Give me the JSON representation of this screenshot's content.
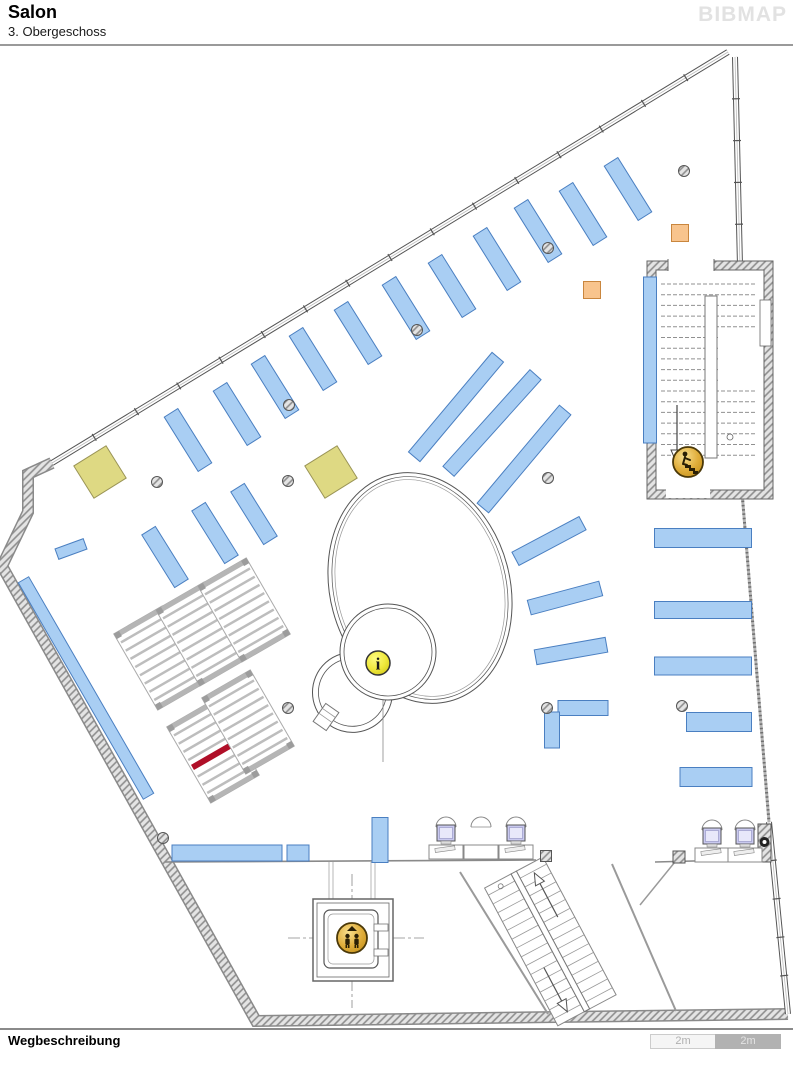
{
  "header": {
    "title": "Salon",
    "subtitle": "3. Obergeschoss",
    "logo": "BIBMAP"
  },
  "footer": {
    "directions_label": "Wegbeschreibung",
    "scale_segments": [
      {
        "label": "2m",
        "variant": "light"
      },
      {
        "label": "2m",
        "variant": "dark"
      }
    ]
  },
  "colors": {
    "shelf_fill": "#a9cef3",
    "shelf_stroke": "#4a7fc1",
    "accent_beige_fill": "#ded983",
    "accent_beige_stroke": "#9a9456",
    "accent_orange_fill": "#f8c48d",
    "accent_orange_stroke": "#c9863e",
    "highlight_red": "#b00f28",
    "icon_gold_light": "#f8df8e",
    "icon_gold_dark": "#c9951f",
    "icon_outline": "#4a3808",
    "info_yellow_light": "#fdfb80",
    "info_yellow_dark": "#d6cd1f",
    "wall_gray": "#8a8a8a",
    "line_gray": "#555555",
    "monitor_screen": "#c9c9ef"
  },
  "map": {
    "shelves": [
      [
        628,
        189,
        16,
        64,
        -32
      ],
      [
        583,
        214,
        16,
        64,
        -32
      ],
      [
        538,
        231,
        16,
        64,
        -32
      ],
      [
        497,
        259,
        16,
        64,
        -32
      ],
      [
        452,
        286,
        16,
        64,
        -32
      ],
      [
        406,
        308,
        16,
        64,
        -32
      ],
      [
        358,
        333,
        16,
        64,
        -32
      ],
      [
        313,
        359,
        16,
        64,
        -32
      ],
      [
        275,
        387,
        16,
        64,
        -32
      ],
      [
        237,
        414,
        16,
        64,
        -32
      ],
      [
        188,
        440,
        16,
        64,
        -32
      ],
      [
        165,
        557,
        16,
        62,
        -32
      ],
      [
        215,
        533,
        16,
        62,
        -32
      ],
      [
        254,
        514,
        16,
        62,
        -32
      ],
      [
        86,
        688,
        12,
        250,
        -30
      ],
      [
        71,
        549,
        30,
        11,
        -20
      ],
      [
        456,
        407,
        15,
        130,
        40
      ],
      [
        492,
        423,
        15,
        130,
        42
      ],
      [
        524,
        459,
        15,
        128,
        40
      ],
      [
        549,
        541,
        15,
        76,
        62
      ],
      [
        565,
        598,
        15,
        74,
        75
      ],
      [
        571,
        651,
        15,
        72,
        80
      ],
      [
        703,
        538,
        97,
        19,
        0
      ],
      [
        703,
        610,
        97,
        17,
        0
      ],
      [
        703,
        666,
        97,
        18,
        0
      ],
      [
        719,
        722,
        65,
        19,
        0
      ],
      [
        716,
        777,
        72,
        19,
        0
      ],
      [
        650,
        360,
        13,
        166,
        0
      ],
      [
        583,
        708,
        50,
        15,
        0
      ],
      [
        552,
        730,
        15,
        36,
        0
      ],
      [
        227,
        853,
        110,
        16,
        0
      ],
      [
        298,
        853,
        22,
        16,
        0
      ],
      [
        380,
        840,
        16,
        45,
        0
      ]
    ],
    "beige_squares": [
      [
        100,
        472
      ],
      [
        331,
        472
      ]
    ],
    "orange_squares": [
      [
        592,
        290
      ],
      [
        680,
        233
      ]
    ],
    "columns": [
      [
        157,
        482
      ],
      [
        288,
        481
      ],
      [
        289,
        405
      ],
      [
        417,
        330
      ],
      [
        548,
        248
      ],
      [
        684,
        171
      ],
      [
        548,
        478
      ],
      [
        288,
        708
      ],
      [
        547,
        708
      ],
      [
        682,
        706
      ],
      [
        163,
        838
      ]
    ],
    "square_columns": [
      [
        546,
        856,
        11
      ],
      [
        679,
        857,
        12
      ]
    ],
    "ladders": [
      [
        160,
        658
      ],
      [
        202,
        634
      ],
      [
        244,
        610
      ],
      [
        213,
        751
      ],
      [
        248,
        722
      ]
    ],
    "highlight_ladder_index": 3,
    "icons": [
      {
        "name": "info-icon",
        "x": 378,
        "y": 663,
        "glyph": "i"
      },
      {
        "name": "elevator-icon",
        "x": 352,
        "y": 938
      },
      {
        "name": "stairs-icon",
        "x": 688,
        "y": 462
      }
    ],
    "workstations": [
      [
        446,
        845,
        1
      ],
      [
        481,
        845,
        0
      ],
      [
        516,
        845,
        1
      ],
      [
        712,
        848,
        1
      ],
      [
        745,
        848,
        1
      ]
    ]
  }
}
